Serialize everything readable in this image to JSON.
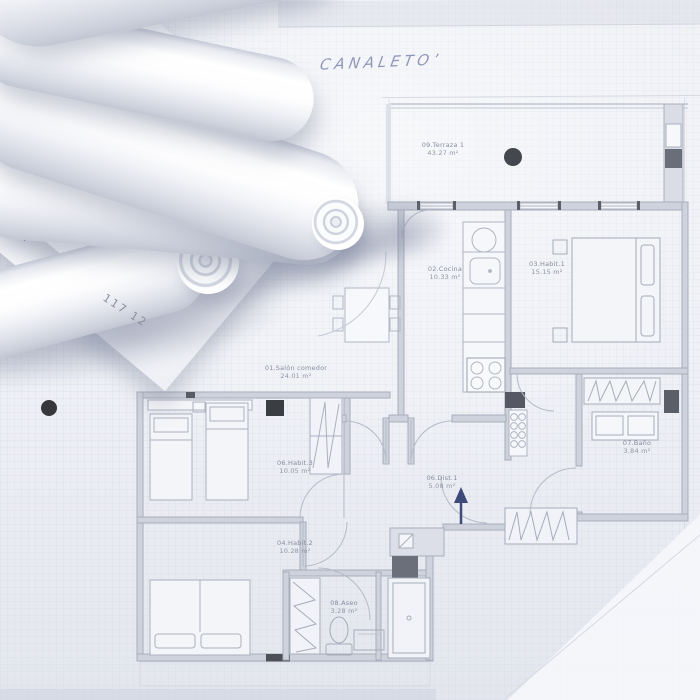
{
  "scene": {
    "handwritten_title": "CANALETO’",
    "paper_note": "117 12",
    "total_label": "Total"
  },
  "floor_plan": {
    "rooms": {
      "salon": {
        "name": "01.Salón comedor",
        "area": "24.01 m²"
      },
      "cocina": {
        "name": "02.Cocina",
        "area": "10.33 m²"
      },
      "habit1": {
        "name": "03.Habit.1",
        "area": "15.15 m²"
      },
      "habit2": {
        "name": "04.Habit.2",
        "area": "10.28 m²"
      },
      "dist1": {
        "name": "06.Dist.1",
        "area": "5.08 m²"
      },
      "habit3": {
        "name": "06.Habit.3",
        "area": "10.05 m²"
      },
      "bano": {
        "name": "07.Baño",
        "area": "3.84 m²"
      },
      "aseo": {
        "name": "08.Aseo",
        "area": "3.28 m²"
      },
      "terraza": {
        "name": "09.Terraza 1",
        "area": "43.27 m²"
      }
    },
    "colors": {
      "paper": "#eef0f5",
      "plan_line": "#a9aebc",
      "wall_fill": "#ccd0db",
      "marker_dark": "#46494f",
      "north_arrow": "#3e4a7a",
      "pencil_blue": "#7d88b4"
    }
  }
}
